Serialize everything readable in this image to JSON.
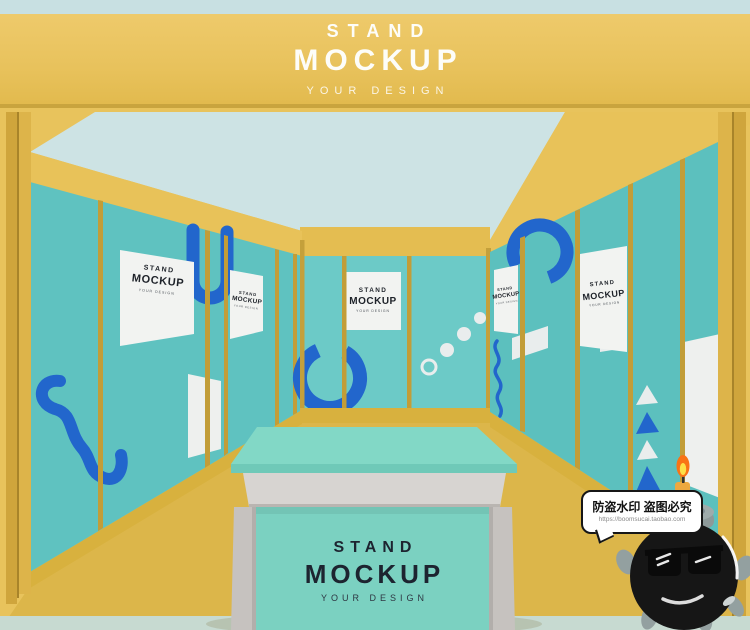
{
  "header": {
    "line1": "STAND",
    "line2": "MOCKUP",
    "tagline": "YOUR DESIGN"
  },
  "poster": {
    "line1": "STAND",
    "line2": "MOCKUP",
    "tagline": "YOUR DESIGN"
  },
  "podium": {
    "line1": "STAND",
    "line2": "MOCKUP",
    "tagline": "YOUR DESIGN"
  },
  "watermark": {
    "notice": "防盗水印 盗图必究",
    "url": "https://boomsucai.taobao.com"
  },
  "colors": {
    "banner_gold": "#e8c25c",
    "frame_gold": "#c29d38",
    "wall_teal": "#63c5c2",
    "ceiling_blue": "#cde3e4",
    "floor_yellow": "#dcb64a",
    "accent_blue": "#2266cc",
    "poster_white": "#f2f3f1",
    "podium_mint": "#7bd1c1",
    "podium_gray": "#d7d4d1",
    "bottom_strip": "#c7dad1"
  }
}
